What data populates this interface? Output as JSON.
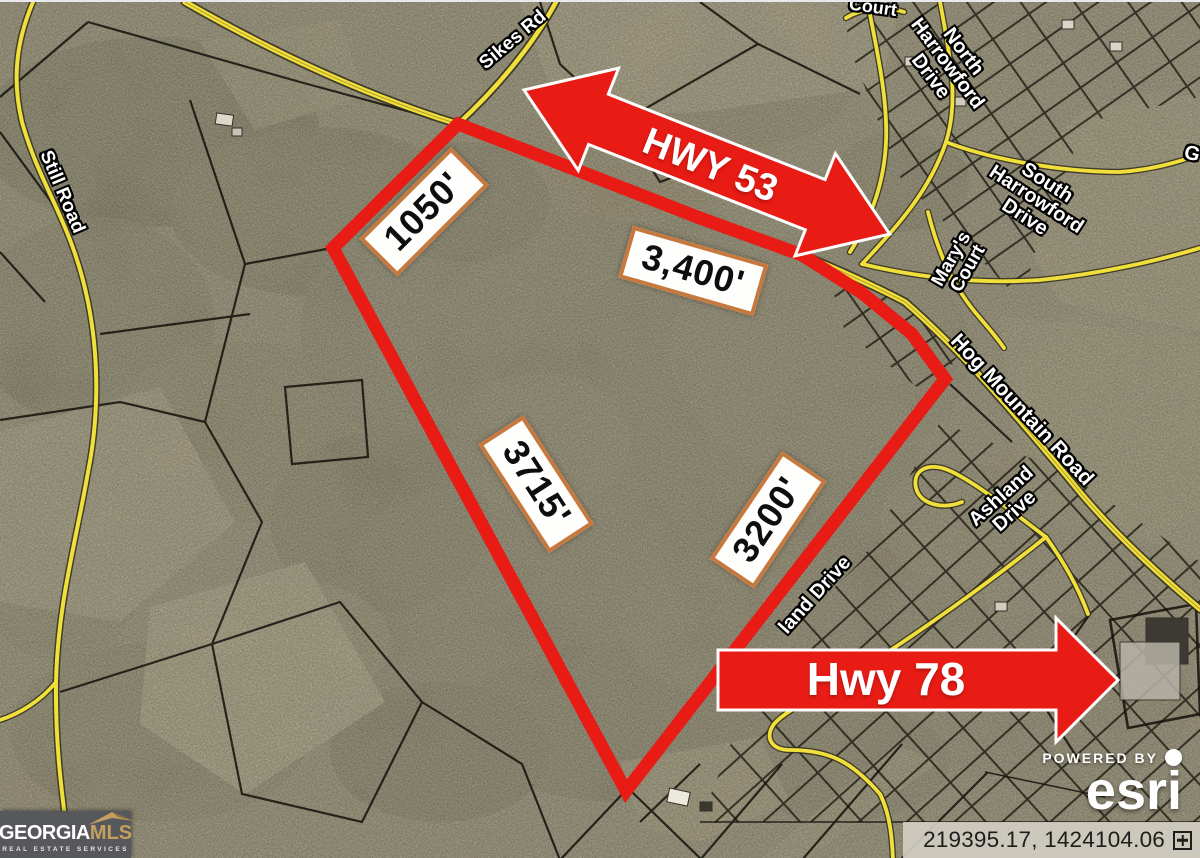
{
  "map": {
    "boundary": {
      "color": "#e81c15",
      "dimensions": [
        {
          "label": "1050'"
        },
        {
          "label": "3,400'"
        },
        {
          "label": "3715'"
        },
        {
          "label": "3200'"
        }
      ]
    },
    "highway_arrows": [
      {
        "label": "HWY 53"
      },
      {
        "label": "Hwy 78"
      }
    ],
    "road_labels": {
      "sikes": {
        "text": "Sikes Rd"
      },
      "still": {
        "text": "Still Road"
      },
      "court_top": {
        "text": "Court"
      },
      "north_harrowford": {
        "lines": [
          "North",
          "Harrowford",
          "Drive"
        ]
      },
      "south_harrowford": {
        "lines": [
          "South",
          "Harrowford",
          "Drive"
        ]
      },
      "marys_court": {
        "lines": [
          "Mary's",
          "Court"
        ]
      },
      "hog_mountain": {
        "text": "Hog Mountain Road"
      },
      "ashland": {
        "lines": [
          "Ashland",
          "Drive"
        ]
      },
      "ashland_partial": {
        "text": "land Drive"
      },
      "g_partial": {
        "text": "G"
      }
    },
    "colors": {
      "road_yellow": "#f1df3b",
      "dimension_box_border": "#c6793f"
    }
  },
  "branding": {
    "georgia_mls": {
      "primary": "GEORGIA",
      "secondary": "MLS",
      "tagline": "REAL ESTATE SERVICES",
      "gold": "#c4a05e"
    },
    "esri": {
      "powered_by": "POWERED BY",
      "name": "esri"
    }
  },
  "statusbar": {
    "coordinates": "219395.17, 1424104.06"
  }
}
